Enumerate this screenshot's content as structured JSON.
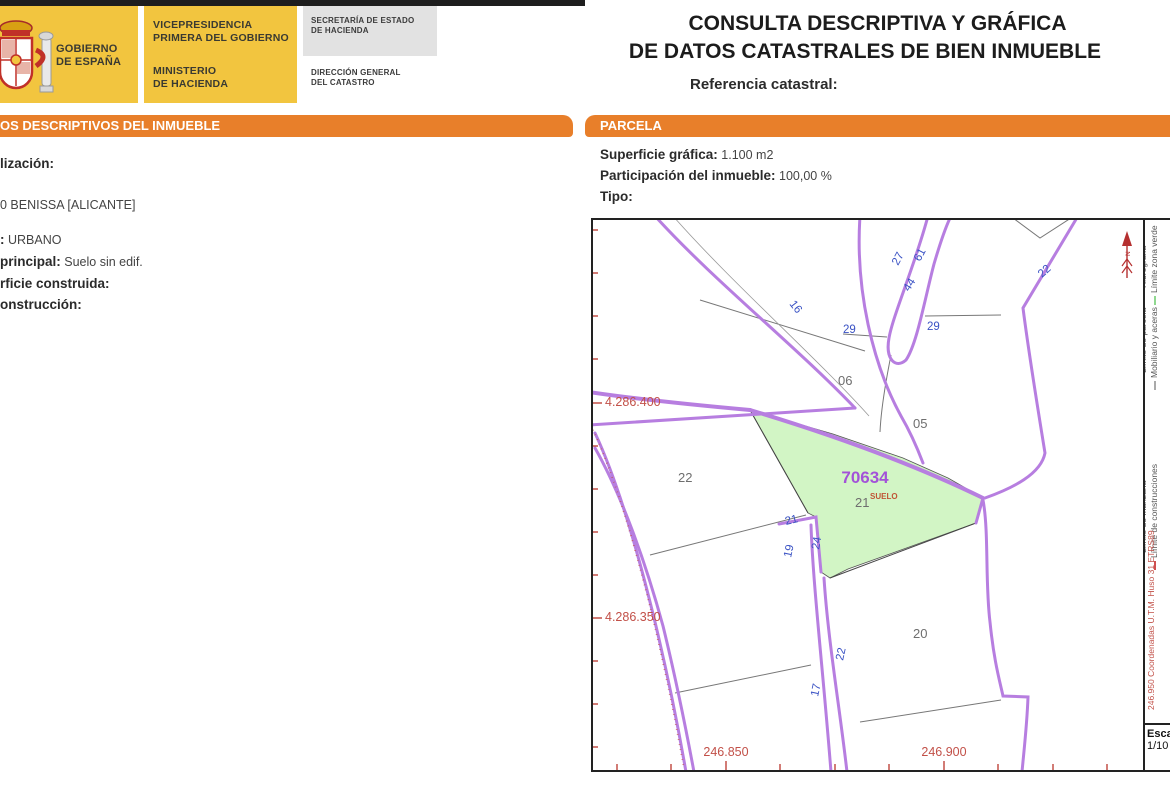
{
  "header": {
    "gobierno_line1": "GOBIERNO",
    "gobierno_line2": "DE ESPAÑA",
    "vicepresidencia_line1": "VICEPRESIDENCIA",
    "vicepresidencia_line2": "PRIMERA DEL GOBIERNO",
    "ministerio_line1": "MINISTERIO",
    "ministerio_line2": "DE HACIENDA",
    "secretaria_line1": "SECRETARÍA DE ESTADO",
    "secretaria_line2": "DE HACIENDA",
    "direccion_line1": "DIRECCIÓN GENERAL",
    "direccion_line2": "DEL CATASTRO",
    "title_line1": "CONSULTA DESCRIPTIVA Y GRÁFICA",
    "title_line2": "DE DATOS CATASTRALES DE BIEN INMUEBLE",
    "referencia_label": "Referencia catastral:"
  },
  "left_section": {
    "header": "OS DESCRIPTIVOS DEL INMUEBLE",
    "f0_label": "lización:",
    "f1_value": "0 BENISSA [ALICANTE]",
    "f2_label": ":",
    "f2_value": "URBANO",
    "f3_label": "principal:",
    "f3_value": "Suelo sin edif.",
    "f4_label": "rficie construida:",
    "f5_label": "onstrucción:"
  },
  "parcela_section": {
    "header": "PARCELA",
    "f0_label": "Superficie gráfica:",
    "f0_value": "1.100 m2",
    "f1_label": "Participación del inmueble:",
    "f1_value": "100,00 %",
    "f2_label": "Tipo:"
  },
  "map": {
    "highlight_id": "70634",
    "highlight_sublabel": "SUELO",
    "parcels": {
      "p06": "06",
      "p05": "05",
      "p22": "22",
      "p21": "21",
      "p20": "20"
    },
    "road_numbers": {
      "n16": "16",
      "n27": "27",
      "n61": "61",
      "n44": "44",
      "n29a": "29",
      "n29b": "29",
      "n22a": "22",
      "n21": "21",
      "n19": "19",
      "n24": "24",
      "n22b": "22",
      "n17": "17"
    },
    "coord_left_1": "4.286.400",
    "coord_left_2": "4.286.350",
    "coord_bottom_1": "246.850",
    "coord_bottom_2": "246.900",
    "north_label": "N",
    "utm_note": "246.950 Coordenadas U.T.M. Huso 31 ETRS89",
    "scale_line1": "Esca",
    "scale_line2": "1/10",
    "legend": [
      {
        "label": "Hidrografía",
        "color": "#7878e8"
      },
      {
        "label": "Límite zona verde",
        "color": "#90d890"
      },
      {
        "label": "Límite de parcela",
        "color": "#333333"
      },
      {
        "label": "Mobiliario y aceras",
        "color": "#aaaaaa"
      },
      {
        "label": "Límite de manzana",
        "color": "#c465e0"
      },
      {
        "label": "Límite de construcciones",
        "color": "#d05050"
      }
    ],
    "colors": {
      "parcel_line": "#b77ee0",
      "highlight_fill": "#d2f5c5",
      "coordinate_red": "#c25048",
      "road_number_blue": "#3a52c4",
      "accent_orange": "#e87f2a",
      "logo_yellow": "#f2c53f"
    }
  }
}
